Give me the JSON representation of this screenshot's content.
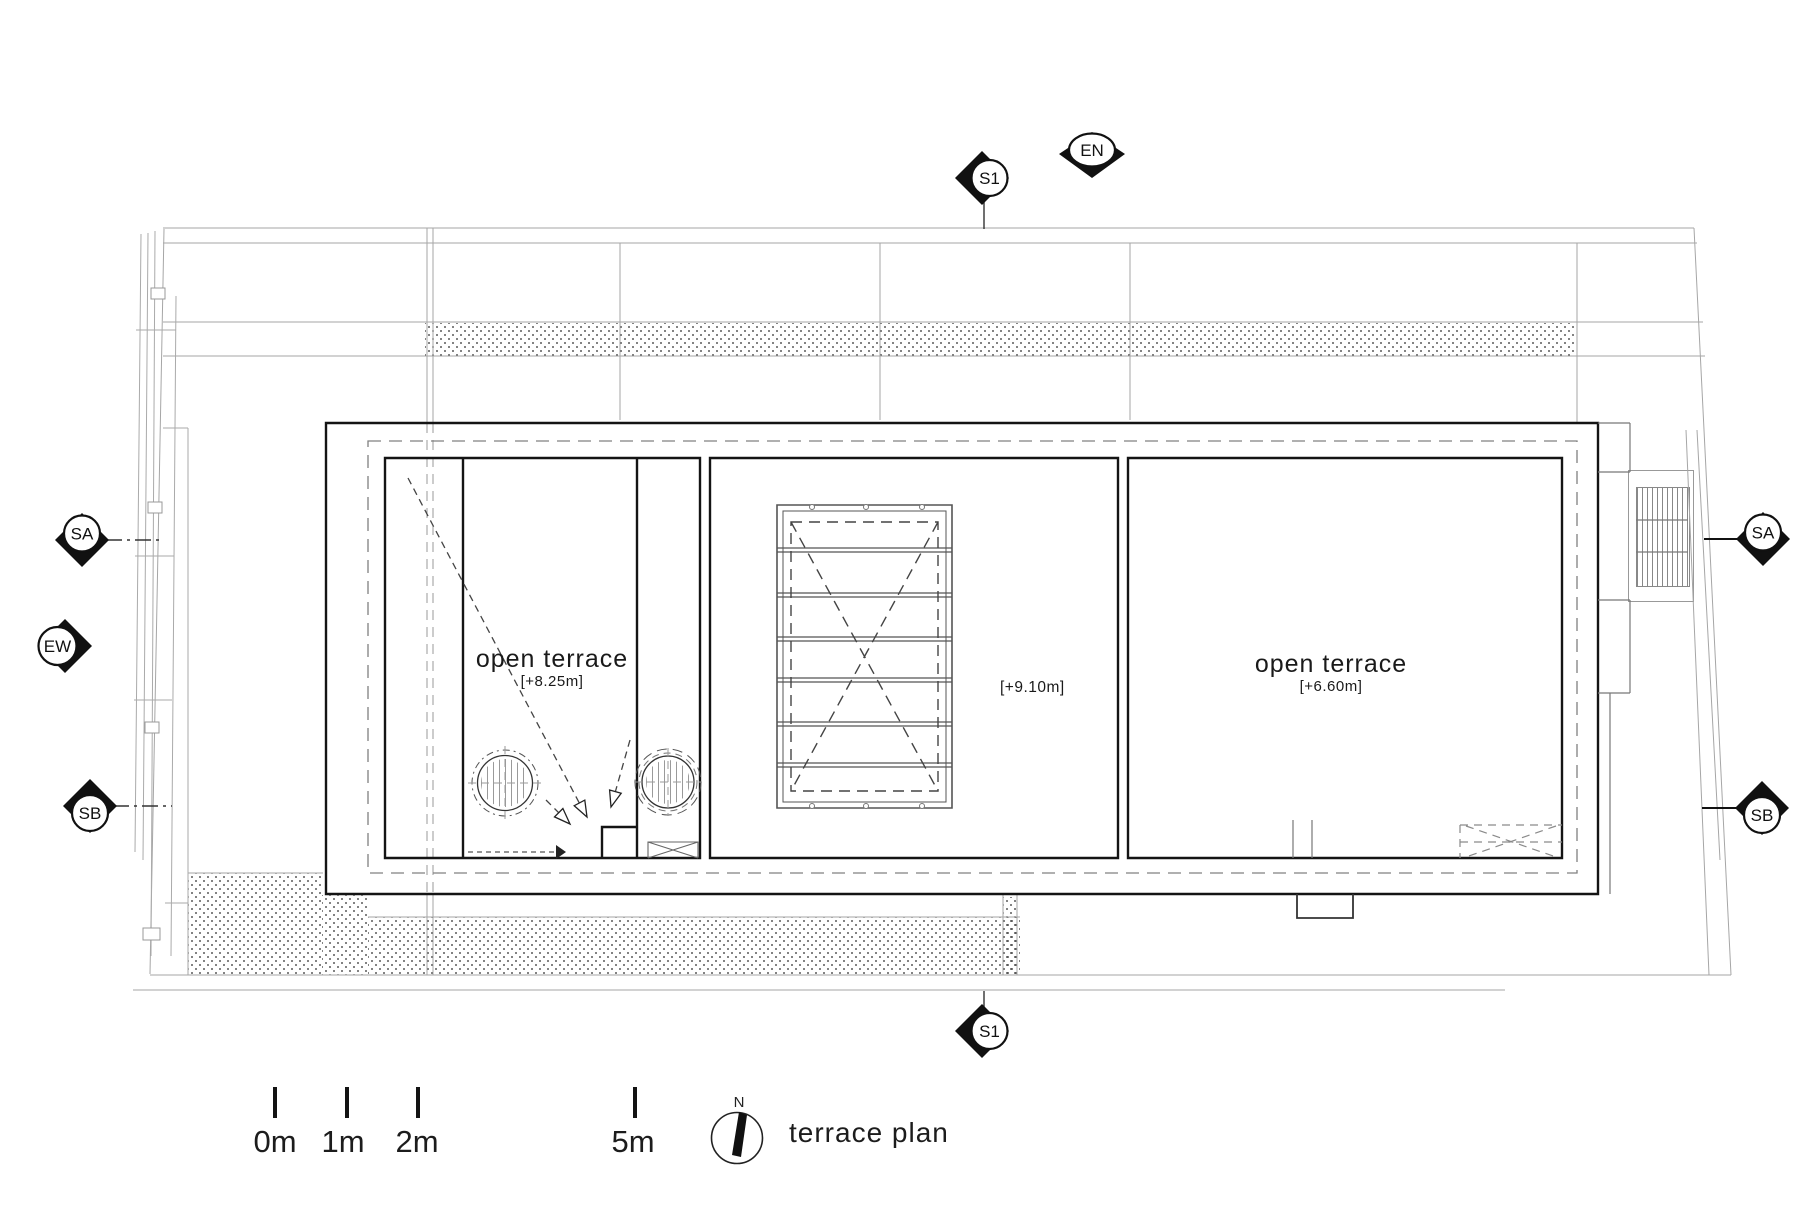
{
  "title": {
    "plan_label": "terrace plan"
  },
  "north": {
    "label": "N"
  },
  "labels": {
    "terrace_left": {
      "name": "open terrace",
      "elevation": "[+8.25m]"
    },
    "terrace_right": {
      "name": "open terrace",
      "elevation": "[+6.60m]"
    },
    "elevation_mid": "[+9.10m]"
  },
  "scale_bar": {
    "ticks": [
      "0m",
      "1m",
      "2m",
      "5m"
    ]
  },
  "markers": {
    "s1_top": "S1",
    "en": "EN",
    "sa_left": "SA",
    "ew_left": "EW",
    "sb_left": "SB",
    "sa_right": "SA",
    "sb_right": "SB",
    "s1_bottom": "S1"
  },
  "colors": {
    "line_bold": "#141414",
    "line_light": "#a0a0a0",
    "line_dash": "#808080"
  }
}
